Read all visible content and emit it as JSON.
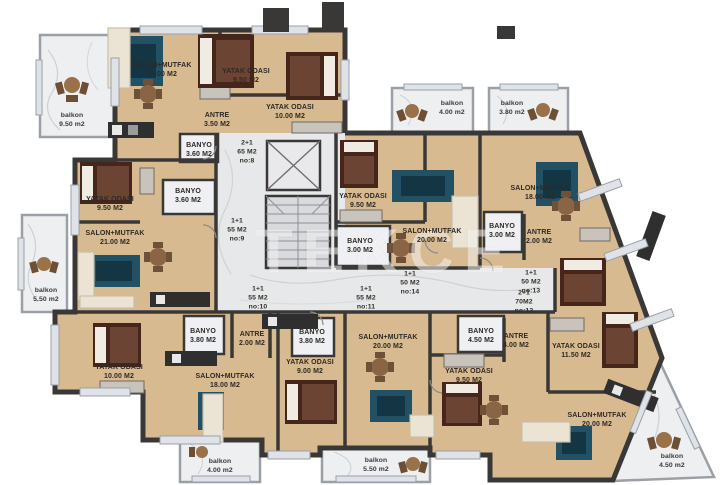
{
  "watermark": "TEKCE",
  "colors": {
    "floor_wood": "#d8ba90",
    "wall": "#3a3836",
    "corridor_marble": "#e7e8ea",
    "balcony_marble": "#edeff1",
    "rug_teal": "#225064",
    "bed_brown": "#46251a",
    "sofa_cream": "#ebe4d4",
    "counter_dark": "#2f2f2f",
    "label_text": "#2e2a26"
  },
  "rooms": [
    {
      "name": "SALON+MUTFAK",
      "area": "18.00 M2"
    },
    {
      "name": "YATAK ODASI",
      "area": "9.50 M2"
    },
    {
      "name": "ANTRE",
      "area": "3.50 M2"
    },
    {
      "name": "BANYO",
      "area": "3.60 M2"
    },
    {
      "name": "YATAK ODASI",
      "area": "10.00 M2"
    },
    {
      "name": "YATAK ODASI",
      "area": "9.50 M2"
    },
    {
      "name": "BANYO",
      "area": "3.60 M2"
    },
    {
      "name": "SALON+MUTFAK",
      "area": "21.00 M2"
    },
    {
      "name": "YATAK ODASI",
      "area": "9.50 M2"
    },
    {
      "name": "BANYO",
      "area": "3.00 M2"
    },
    {
      "name": "SALON+MUTFAK",
      "area": "20.00 M2"
    },
    {
      "name": "SALON+MUTFAK",
      "area": "18.00 M2"
    },
    {
      "name": "BANYO",
      "area": "3.00 M2"
    },
    {
      "name": "ANTRE",
      "area": "2.00 M2"
    },
    {
      "name": "BANYO",
      "area": "3.80 M2"
    },
    {
      "name": "ANTRE",
      "area": "2.00 M2"
    },
    {
      "name": "BANYO",
      "area": "3.80 M2"
    },
    {
      "name": "YATAK ODASI",
      "area": "9.00 M2"
    },
    {
      "name": "YATAK ODASI",
      "area": "10.00 M2"
    },
    {
      "name": "SALON+MUTFAK",
      "area": "18.00 M2"
    },
    {
      "name": "SALON+MUTFAK",
      "area": "20.00 M2"
    },
    {
      "name": "BANYO",
      "area": "4.50 M2"
    },
    {
      "name": "ANTRE",
      "area": "4.00 M2"
    },
    {
      "name": "YATAK ODASI",
      "area": "9.50 M2"
    },
    {
      "name": "YATAK ODASI",
      "area": "11.50 M2"
    },
    {
      "name": "SALON+MUTFAK",
      "area": "20.00 M2"
    }
  ],
  "units": [
    {
      "type": "2+1",
      "size": "65 M2",
      "no": "no:8"
    },
    {
      "type": "1+1",
      "size": "55 M2",
      "no": "no:9"
    },
    {
      "type": "1+1",
      "size": "55 M2",
      "no": "no:10"
    },
    {
      "type": "1+1",
      "size": "55 M2",
      "no": "no:11"
    },
    {
      "type": "2+1",
      "size": "70M2",
      "no": "no:12"
    },
    {
      "type": "1+1",
      "size": "50 M2",
      "no": "no:13"
    },
    {
      "type": "1+1",
      "size": "50 M2",
      "no": "no:14"
    }
  ],
  "balconies": [
    {
      "name": "balkon",
      "area": "9.50 m2"
    },
    {
      "name": "balkon",
      "area": "4.00 m2"
    },
    {
      "name": "balkon",
      "area": "3.80 m2"
    },
    {
      "name": "balkon",
      "area": "5.50 m2"
    },
    {
      "name": "balkon",
      "area": "4.00 m2"
    },
    {
      "name": "balkon",
      "area": "5.50 m2"
    },
    {
      "name": "balkon",
      "area": "4.50 m2"
    }
  ]
}
